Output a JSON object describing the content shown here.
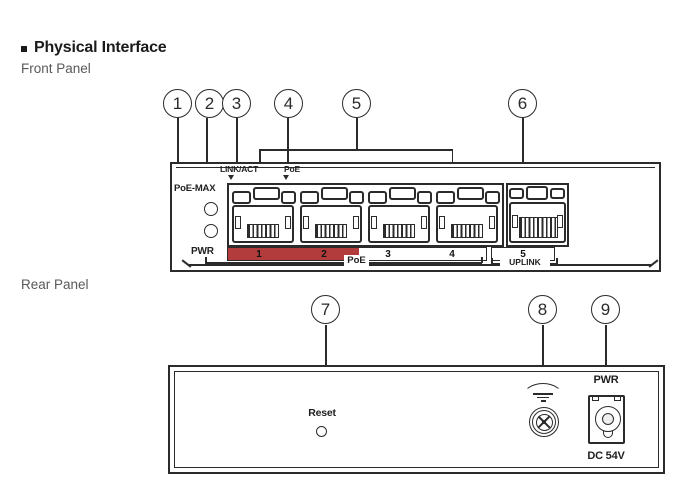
{
  "header": {
    "bullet": "▪",
    "title": "Physical Interface",
    "front_panel_label": "Front Panel",
    "rear_panel_label": "Rear Panel"
  },
  "colors": {
    "line": "#2b2b2b",
    "poe_red": "#b23c3c",
    "muted_text": "#595959"
  },
  "front": {
    "callouts": [
      "1",
      "2",
      "3",
      "4",
      "5",
      "6"
    ],
    "poe_max_label": "PoE-MAX",
    "pwr_label": "PWR",
    "link_act_label": "LINK/ACT",
    "poe_led_label": "PoE",
    "port_numbers": [
      "1",
      "2",
      "3",
      "4",
      "5"
    ],
    "poe_group_label": "PoE",
    "uplink_group_label": "UPLINK"
  },
  "rear": {
    "callouts": [
      "7",
      "8",
      "9"
    ],
    "reset_label": "Reset",
    "pwr_label": "PWR",
    "dc_label": "DC 54V"
  }
}
